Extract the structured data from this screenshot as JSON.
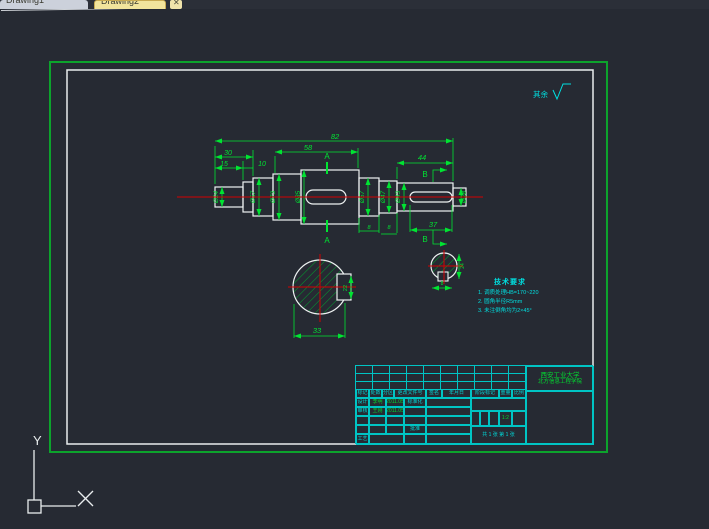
{
  "window": {
    "tab1_label": "Drawing1",
    "tab2_label": "Drawing2",
    "close_label": "✕"
  },
  "drawing": {
    "dims": {
      "total": "82",
      "hub": "58",
      "left_group": "30",
      "left_end": "15",
      "collar": "10",
      "right_section": "44",
      "keyway_right": "37",
      "section_a_width": "33",
      "groove_a": "8",
      "groove_b": "8",
      "keyway_a_width": "22",
      "section_b_flat": "24",
      "section_b_key": "8"
    },
    "diameters": {
      "d1": "Ø24",
      "d2": "Ø57",
      "d3": "Ø73",
      "d4": "Ø85",
      "d5": "Ø57",
      "d6": "Ø47",
      "d7": "Ø43",
      "d8": "Ø28"
    },
    "markers": {
      "section_a": "A",
      "section_b": "B"
    },
    "roughness_note": "其余"
  },
  "tech_req": {
    "title": "技术要求",
    "item1": "1. 调质处理HB=170~220",
    "item2": "2. 圆角半径R5mm",
    "item3": "3. 未注倒角均为2×45°"
  },
  "title_block": {
    "org_line1": "西安工业大学",
    "org_line2": "北方信息工程学院",
    "h_mark": "标记",
    "h_count": "处数",
    "h_zone": "分区",
    "h_doc": "更改文件号",
    "h_sign": "签名",
    "h_date": "年月日",
    "design_label": "设计",
    "design_name": "李明",
    "design_date": "2011.05",
    "check_label": "审核",
    "check_name": "王刚",
    "check_date": "2011.05",
    "std_label": "标准化",
    "approve_label": "批准",
    "process_label": "工艺",
    "stage_label": "阶段标记",
    "weight_label": "重量",
    "scale_label": "比例",
    "scale_value": "1:2",
    "sheet_info": "共 1 张 第 1 张"
  },
  "ucs": {
    "y_label": "Y"
  }
}
